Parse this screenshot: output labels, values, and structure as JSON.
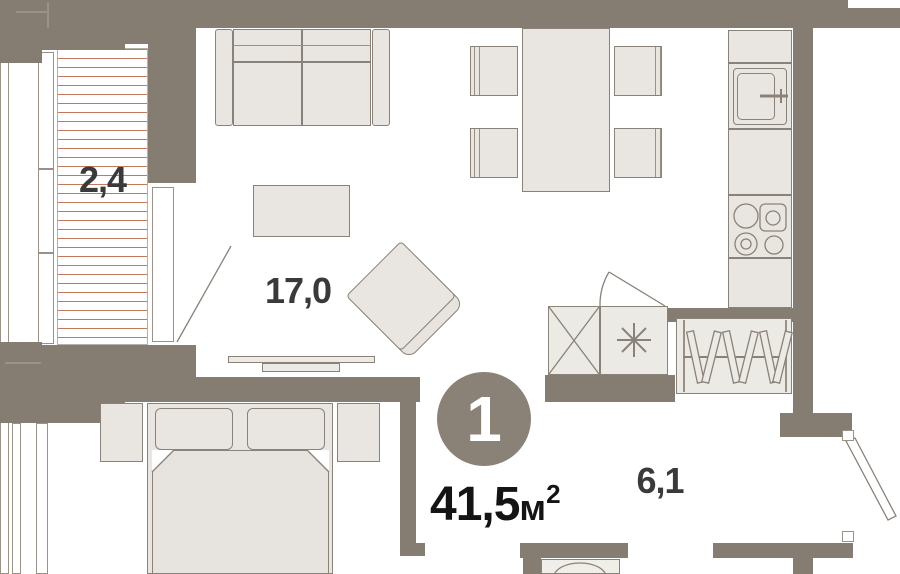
{
  "labels": {
    "balcony_area": "2,4",
    "living_area": "17,0",
    "hallway_area": "6,1",
    "rooms_badge": "1",
    "total_area_value": "41,5",
    "total_area_unit": "м",
    "total_area_sup": "2"
  },
  "colors": {
    "wall": "#867d72",
    "furniture_fill": "#e9e6e1",
    "furniture_stroke": "#8a8278",
    "hatch_line": "#c0795c",
    "badge_fill": "#8a8177",
    "badge_text": "#ffffff",
    "room_label_text": "#3a3a3a",
    "total_area_text": "#141414"
  }
}
